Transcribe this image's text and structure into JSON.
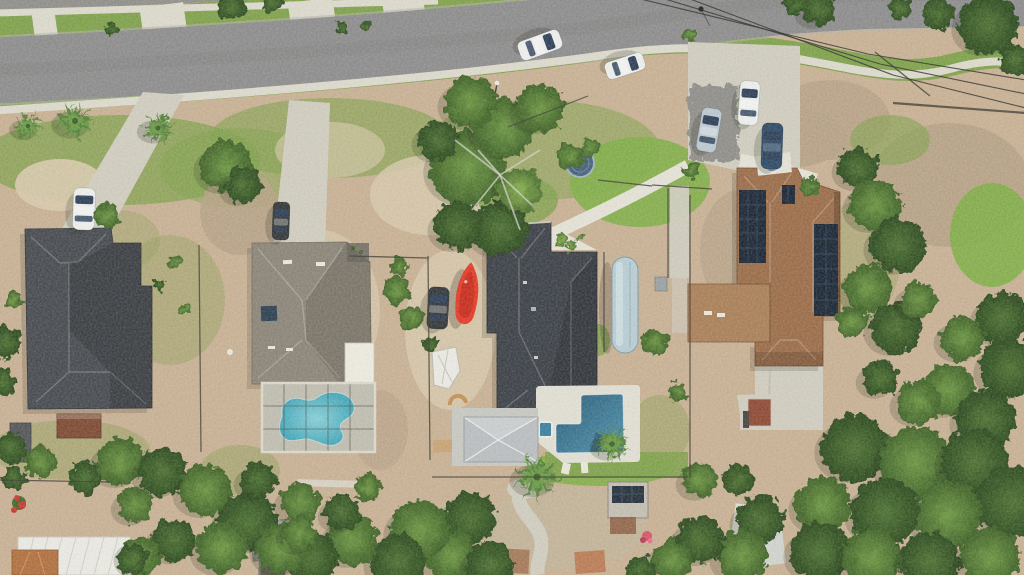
{
  "image_kind": "aerial-drone-photo-residential-neighborhood",
  "colors": {
    "road": "#8d8c8d",
    "roadEdge": "#b5b2a7",
    "asphaltOld": "#8f8e8a",
    "sidewalk": "#dbd8cc",
    "concrete": "#cfccbf",
    "concreteBright": "#e3e1d6",
    "sand": "#c7b094",
    "sandLight": "#d8c9ad",
    "grass": "#7fa14c",
    "grassBright": "#7fae47",
    "scrub": "#93a05e",
    "mulch": "#b5a186",
    "mulchLight": "#c2b49b",
    "treeDark": "#2f4d22",
    "treeMid": "#44682e",
    "treeLight": "#63903c",
    "palm": "#5d8c3b",
    "roofA": "#474b50",
    "roofB": "#8b8478",
    "roofBdeck": "#77726a",
    "roofC": "#3c4148",
    "roofD": "#9a6c49",
    "roofDlight": "#a97f58",
    "solar": "#1c2735",
    "screenPoolWater": "#58c0d4",
    "poolDeep": "#2a5a78",
    "poolLight": "#4f93ad",
    "spa": "#3a7fa0",
    "deck": "#e0ded3",
    "enclosureDeck": "#cbc8bb",
    "screen": "#4e4e46",
    "frame": "#dad7cb",
    "gazebo": "#b9bdc0",
    "gazeboLight": "#c9cdd0",
    "kayak": "#e23a26",
    "kayakDark": "#b02318",
    "rv": "#b7ccd3",
    "rvEdge": "#7f98a2",
    "carWhite": "#eceeed",
    "carSilver": "#bac7d0",
    "carBlue": "#2e4a66",
    "carDark": "#34373a",
    "glass": "#2e4058",
    "shedBrown": "#7d4a34",
    "shedDark": "#55565a",
    "shedWhite": "#e9e8e2",
    "terracotta": "#b0703f",
    "brick": "#8d4a36",
    "grayRoof": "#9a9b97",
    "trampoline": "#47617a",
    "trampolineRim": "#9fb0bd",
    "fence": "#4a493f",
    "wire": "#403f39",
    "branch": "#cdd2c3",
    "flowerRed": "#c23b2e",
    "flowerPink": "#d4566a"
  },
  "scene": {
    "patches": [
      [
        120,
        160,
        140,
        45,
        "grass",
        0.75
      ],
      [
        330,
        138,
        120,
        40,
        "grass",
        0.6
      ],
      [
        540,
        150,
        120,
        50,
        "grass",
        0.55
      ],
      [
        240,
        168,
        80,
        40,
        "grass",
        0.5
      ],
      [
        640,
        182,
        70,
        45,
        "grassBright",
        0.9
      ],
      [
        150,
        30,
        160,
        18,
        "grass",
        0.9
      ],
      [
        420,
        16,
        120,
        14,
        "grass",
        0.8
      ],
      [
        60,
        185,
        45,
        26,
        "sandLight",
        0.9
      ],
      [
        240,
        213,
        40,
        42,
        "mulch",
        0.85
      ],
      [
        330,
        150,
        55,
        28,
        "sandLight",
        0.6
      ],
      [
        430,
        195,
        60,
        40,
        "sandLight",
        0.8
      ],
      [
        770,
        138,
        78,
        32,
        "mulch",
        0.9
      ],
      [
        830,
        120,
        60,
        40,
        "mulch",
        0.8
      ],
      [
        950,
        185,
        80,
        62,
        "mulch",
        0.9
      ],
      [
        992,
        235,
        42,
        52,
        "grassBright",
        0.9
      ],
      [
        890,
        140,
        40,
        25,
        "grass",
        0.6
      ],
      [
        170,
        300,
        55,
        65,
        "scrub",
        0.45
      ],
      [
        320,
        310,
        60,
        80,
        "sandLight",
        0.7
      ],
      [
        450,
        330,
        45,
        80,
        "sandLight",
        0.8
      ],
      [
        598,
        340,
        12,
        16,
        "grass",
        0.8
      ],
      [
        600,
        468,
        75,
        18,
        "grassBright",
        0.9
      ],
      [
        565,
        528,
        80,
        42,
        "mulchLight",
        0.8
      ],
      [
        740,
        250,
        40,
        60,
        "mulch",
        0.7
      ],
      [
        860,
        260,
        40,
        60,
        "scrub",
        0.4
      ],
      [
        120,
        240,
        40,
        30,
        "scrub",
        0.4
      ],
      [
        380,
        430,
        28,
        40,
        "mulch",
        0.6
      ],
      [
        240,
        470,
        40,
        25,
        "scrub",
        0.5
      ],
      [
        660,
        430,
        30,
        35,
        "scrub",
        0.5
      ],
      [
        518,
        200,
        40,
        25,
        "grass",
        0.8
      ],
      [
        70,
        450,
        80,
        30,
        "scrub",
        0.5
      ]
    ],
    "trees": [
      [
        232,
        6,
        14,
        "d"
      ],
      [
        272,
        3,
        10,
        "d"
      ],
      [
        111,
        29,
        6,
        "d"
      ],
      [
        342,
        27,
        6,
        "d"
      ],
      [
        365,
        27,
        4,
        "d"
      ],
      [
        106,
        216,
        13,
        "m"
      ],
      [
        226,
        166,
        26,
        "m"
      ],
      [
        243,
        185,
        18,
        "d"
      ],
      [
        6,
        342,
        16,
        "d"
      ],
      [
        3,
        382,
        14,
        "d"
      ],
      [
        10,
        448,
        16,
        "d"
      ],
      [
        14,
        300,
        8,
        "m"
      ],
      [
        468,
        168,
        38,
        "m"
      ],
      [
        500,
        228,
        28,
        "d"
      ],
      [
        458,
        226,
        24,
        "d"
      ],
      [
        504,
        128,
        30,
        "m"
      ],
      [
        540,
        108,
        24,
        "m"
      ],
      [
        470,
        102,
        26,
        "m"
      ],
      [
        438,
        140,
        20,
        "d"
      ],
      [
        520,
        190,
        22,
        "l"
      ],
      [
        570,
        156,
        13,
        "m"
      ],
      [
        590,
        148,
        9,
        "m"
      ],
      [
        397,
        290,
        14,
        "m"
      ],
      [
        412,
        318,
        12,
        "m"
      ],
      [
        399,
        266,
        9,
        "m"
      ],
      [
        431,
        345,
        8,
        "d"
      ],
      [
        655,
        342,
        13,
        "m"
      ],
      [
        678,
        392,
        9,
        "m"
      ],
      [
        561,
        240,
        6,
        "l"
      ],
      [
        571,
        246,
        5,
        "l"
      ],
      [
        579,
        238,
        4,
        "l"
      ],
      [
        810,
        187,
        9,
        "m"
      ],
      [
        692,
        170,
        8,
        "m"
      ],
      [
        690,
        35,
        7,
        "m"
      ],
      [
        818,
        8,
        18,
        "d"
      ],
      [
        795,
        4,
        11,
        "d"
      ],
      [
        988,
        25,
        30,
        "d"
      ],
      [
        938,
        14,
        16,
        "d"
      ],
      [
        900,
        8,
        12,
        "d"
      ],
      [
        1016,
        60,
        16,
        "d"
      ],
      [
        858,
        168,
        20,
        "d"
      ],
      [
        875,
        205,
        26,
        "m"
      ],
      [
        898,
        245,
        28,
        "d"
      ],
      [
        868,
        288,
        24,
        "m"
      ],
      [
        896,
        328,
        26,
        "d"
      ],
      [
        852,
        322,
        16,
        "m"
      ],
      [
        918,
        300,
        18,
        "m"
      ],
      [
        1002,
        318,
        26,
        "d"
      ],
      [
        962,
        338,
        22,
        "m"
      ],
      [
        1010,
        368,
        30,
        "d"
      ],
      [
        948,
        390,
        26,
        "m"
      ],
      [
        986,
        420,
        30,
        "d"
      ],
      [
        918,
        402,
        22,
        "m"
      ],
      [
        880,
        378,
        18,
        "d"
      ],
      [
        855,
        448,
        34,
        "d"
      ],
      [
        915,
        462,
        36,
        "m"
      ],
      [
        975,
        462,
        34,
        "d"
      ],
      [
        1012,
        502,
        36,
        "d"
      ],
      [
        948,
        515,
        34,
        "m"
      ],
      [
        885,
        512,
        34,
        "d"
      ],
      [
        823,
        505,
        28,
        "m"
      ],
      [
        820,
        552,
        30,
        "d"
      ],
      [
        872,
        558,
        30,
        "m"
      ],
      [
        930,
        562,
        30,
        "d"
      ],
      [
        990,
        558,
        30,
        "m"
      ],
      [
        760,
        520,
        24,
        "d"
      ],
      [
        742,
        556,
        26,
        "m"
      ],
      [
        700,
        540,
        24,
        "d"
      ],
      [
        672,
        560,
        20,
        "m"
      ],
      [
        700,
        480,
        18,
        "m"
      ],
      [
        738,
        480,
        16,
        "d"
      ],
      [
        470,
        518,
        26,
        "d"
      ],
      [
        452,
        556,
        26,
        "m"
      ],
      [
        490,
        565,
        24,
        "d"
      ],
      [
        640,
        570,
        14,
        "d"
      ],
      [
        420,
        530,
        30,
        "m"
      ],
      [
        398,
        562,
        28,
        "d"
      ],
      [
        352,
        540,
        26,
        "m"
      ],
      [
        312,
        558,
        26,
        "d"
      ],
      [
        300,
        502,
        20,
        "m"
      ],
      [
        342,
        512,
        18,
        "d"
      ],
      [
        368,
        488,
        14,
        "m"
      ],
      [
        120,
        462,
        24,
        "m"
      ],
      [
        162,
        472,
        24,
        "d"
      ],
      [
        205,
        490,
        26,
        "m"
      ],
      [
        248,
        522,
        30,
        "d"
      ],
      [
        282,
        548,
        26,
        "m"
      ],
      [
        222,
        548,
        26,
        "m"
      ],
      [
        174,
        540,
        22,
        "d"
      ],
      [
        140,
        556,
        20,
        "m"
      ],
      [
        258,
        480,
        18,
        "d"
      ],
      [
        300,
        534,
        18,
        "m"
      ],
      [
        135,
        505,
        18,
        "m"
      ],
      [
        85,
        478,
        16,
        "d"
      ],
      [
        40,
        462,
        16,
        "m"
      ],
      [
        14,
        478,
        12,
        "d"
      ],
      [
        132,
        560,
        16,
        "d"
      ],
      [
        175,
        262,
        7,
        "m"
      ],
      [
        160,
        285,
        6,
        "d"
      ],
      [
        185,
        310,
        5,
        "m"
      ]
    ],
    "branches": [
      [
        500,
        175,
        455,
        140
      ],
      [
        500,
        175,
        472,
        210
      ],
      [
        500,
        175,
        540,
        150
      ],
      [
        500,
        175,
        532,
        205
      ],
      [
        500,
        175,
        478,
        150
      ],
      [
        500,
        175,
        520,
        230
      ]
    ],
    "palms": [
      {
        "x": 28,
        "y": 126,
        "s": 1.0,
        "rot": 10
      },
      {
        "x": 75,
        "y": 121,
        "s": 1.35,
        "rot": 0
      },
      {
        "x": 158,
        "y": 128,
        "s": 1.15,
        "rot": 25
      },
      {
        "x": 537,
        "y": 477,
        "s": 1.6,
        "rot": 5
      },
      {
        "x": 612,
        "y": 444,
        "s": 1.25,
        "rot": -15
      }
    ],
    "cars": [
      {
        "name": "car-driving-west",
        "x": 540,
        "y": 45,
        "w": 20,
        "h": 44,
        "rot": 70,
        "body": "carWhite"
      },
      {
        "name": "car-driving-east",
        "x": 625,
        "y": 66,
        "w": 18,
        "h": 40,
        "rot": 72,
        "body": "carWhite"
      },
      {
        "name": "car-parked-silver",
        "x": 709,
        "y": 130,
        "w": 20,
        "h": 44,
        "rot": 10,
        "body": "carSilver"
      },
      {
        "name": "car-parked-white",
        "x": 749,
        "y": 103,
        "w": 20,
        "h": 44,
        "rot": 4,
        "body": "carWhite"
      },
      {
        "name": "car-parked-dark-blue",
        "x": 772,
        "y": 146,
        "w": 21,
        "h": 46,
        "rot": 2,
        "body": "carBlue"
      },
      {
        "name": "car-left-driveway",
        "x": 84,
        "y": 209,
        "w": 22,
        "h": 42,
        "rot": 2,
        "body": "carWhite"
      },
      {
        "name": "car-center-driveway",
        "x": 281,
        "y": 221,
        "w": 17,
        "h": 38,
        "rot": 2,
        "body": "carDark"
      },
      {
        "name": "car-backyard",
        "x": 438,
        "y": 308,
        "w": 21,
        "h": 42,
        "rot": 3,
        "body": "carDark"
      }
    ],
    "fences": [
      [
        199,
        245,
        201,
        452
      ],
      [
        428,
        256,
        430,
        460
      ],
      [
        349,
        256,
        428,
        258
      ],
      [
        652,
        185,
        712,
        189
      ],
      [
        668,
        188,
        668,
        278
      ],
      [
        690,
        195,
        690,
        478
      ],
      [
        604,
        252,
        604,
        352
      ],
      [
        432,
        477,
        688,
        477
      ],
      [
        0,
        480,
        110,
        482
      ],
      [
        893,
        103,
        1026,
        113,
        2.2
      ],
      [
        875,
        52,
        930,
        96,
        1.4
      ],
      [
        508,
        127,
        588,
        96,
        1.2
      ],
      [
        598,
        180,
        652,
        186
      ]
    ],
    "wires": [
      [
        628,
        -4,
        868,
        54,
        1026,
        80
      ],
      [
        655,
        -4,
        880,
        64,
        1026,
        94
      ],
      [
        682,
        -4,
        893,
        75,
        1026,
        108
      ]
    ],
    "aprons": [
      {
        "x": 33,
        "y": 10,
        "w": 23,
        "h": 26,
        "rot": -8
      },
      {
        "x": 141,
        "y": 5,
        "w": 44,
        "h": 25,
        "rot": -8
      },
      {
        "x": 289,
        "y": 0,
        "w": 45,
        "h": 21,
        "rot": -8
      },
      {
        "x": 383,
        "y": 0,
        "w": 41,
        "h": 13,
        "rot": -8
      }
    ]
  }
}
